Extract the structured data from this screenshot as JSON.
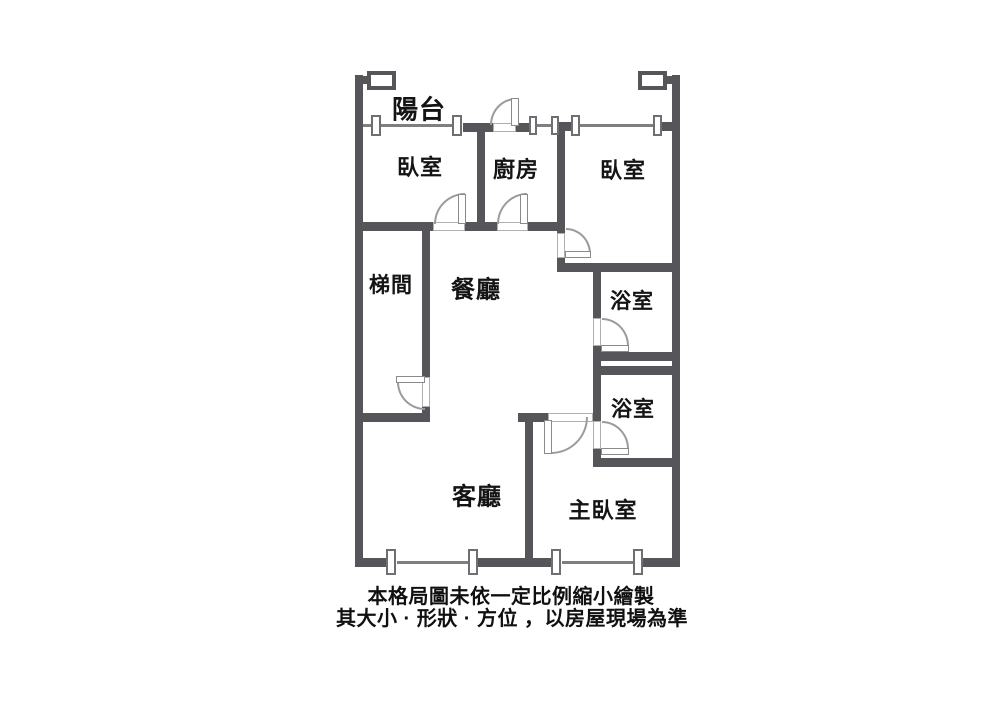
{
  "floor_plan": {
    "rooms": {
      "balcony": {
        "label": "陽台"
      },
      "bedroom_left": {
        "label": "臥室"
      },
      "kitchen": {
        "label": "廚房"
      },
      "bedroom_right": {
        "label": "臥室"
      },
      "stairwell": {
        "label": "梯間"
      },
      "dining": {
        "label": "餐廳"
      },
      "bathroom_upper": {
        "label": "浴室"
      },
      "bathroom_lower": {
        "label": "浴室"
      },
      "living": {
        "label": "客廳"
      },
      "master_bedroom": {
        "label": "主臥室"
      }
    },
    "caption": {
      "line1": "本格局圖未依一定比例縮小繪製",
      "line2": "其大小 · 形狀 · 方位 ，以房屋現場為準"
    },
    "colors": {
      "wall": "#55555a",
      "glass_line": "#7f7f7f",
      "door_arc": "#9b9b9b",
      "text": "#141414",
      "background": "#ffffff"
    }
  }
}
